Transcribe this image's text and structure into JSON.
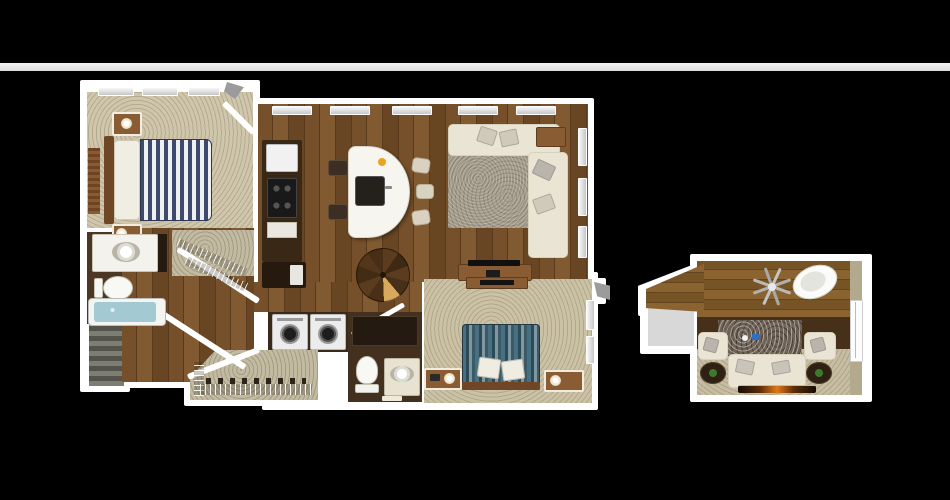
{
  "page": {
    "type": "3d-floor-plan-rendering",
    "background_color": "#000000",
    "top_band_color": "#e9e9e9",
    "visible_text": []
  },
  "palette": {
    "walls": "#ffffff",
    "wood_floor": "#75502a",
    "loft_wood_floor": "#8a6330",
    "bedroom_carpet": "#cfc6ab",
    "closet_carpet": "#c3bba1",
    "bathroom_tile": "#43301f",
    "sofa_cream": "#eae4d4",
    "area_rug_gray": "#a29989",
    "bed1_stripes": [
      "#3e4a6b",
      "#eef0f4"
    ],
    "bed2_stripes": [
      "#477083",
      "#2d4a57",
      "#7e97a0"
    ],
    "furniture_wood": "#8a5c33",
    "kitchen_cabinets": "#3a2817",
    "appliance_white": "#f1f1f1",
    "stove_black": "#191919",
    "tub_water": "#a3c9d2",
    "granite": "#6e6156",
    "fireplace_flame": "#e07818",
    "door_marker_gray": "#9b9b9b"
  },
  "floorplan": {
    "units": [
      {
        "name": "main-unit",
        "rooms": [
          "bedroom-1",
          "bathroom-1",
          "walk-in-closet-1",
          "hallway",
          "entry-stairs",
          "kitchen",
          "living-dining-area",
          "spiral-staircase",
          "laundry-closet",
          "bathroom-2",
          "walk-in-closet-2",
          "bedroom-2"
        ],
        "furniture": {
          "bedroom-1": [
            "striped-bed",
            "headboard",
            "nightstand-top",
            "nightstand-bottom",
            "lamps",
            "slatted-runner",
            "windows"
          ],
          "bathroom-1": [
            "vanity-sink",
            "toilet",
            "bathtub"
          ],
          "kitchen": [
            "refrigerator",
            "range",
            "counter-run",
            "curved-island",
            "island-sink",
            "bar-stools",
            "dark-stools"
          ],
          "living-dining-area": [
            "sectional-sofa",
            "chaise",
            "throw-pillows",
            "area-rug",
            "side-table",
            "tv-console",
            "tv"
          ],
          "laundry-closet": [
            "washer",
            "dryer"
          ],
          "bathroom-2": [
            "walk-in-shower",
            "toilet",
            "vanity-sink"
          ],
          "walk-in-closet-2": [
            "wire-shelving",
            "shoe-row"
          ],
          "bedroom-2": [
            "teal-striped-bed",
            "pillows",
            "nightstand-left",
            "nightstand-right",
            "dresser-tv"
          ]
        }
      },
      {
        "name": "loft-unit",
        "rooms": [
          "loft-lounge",
          "stair-landing"
        ],
        "furniture": {
          "loft-lounge": [
            "sofa",
            "armchair-left",
            "armchair-right",
            "side-tables",
            "stone-rug",
            "egg-chair",
            "ceiling-fan",
            "fireplace",
            "window"
          ]
        }
      }
    ]
  }
}
